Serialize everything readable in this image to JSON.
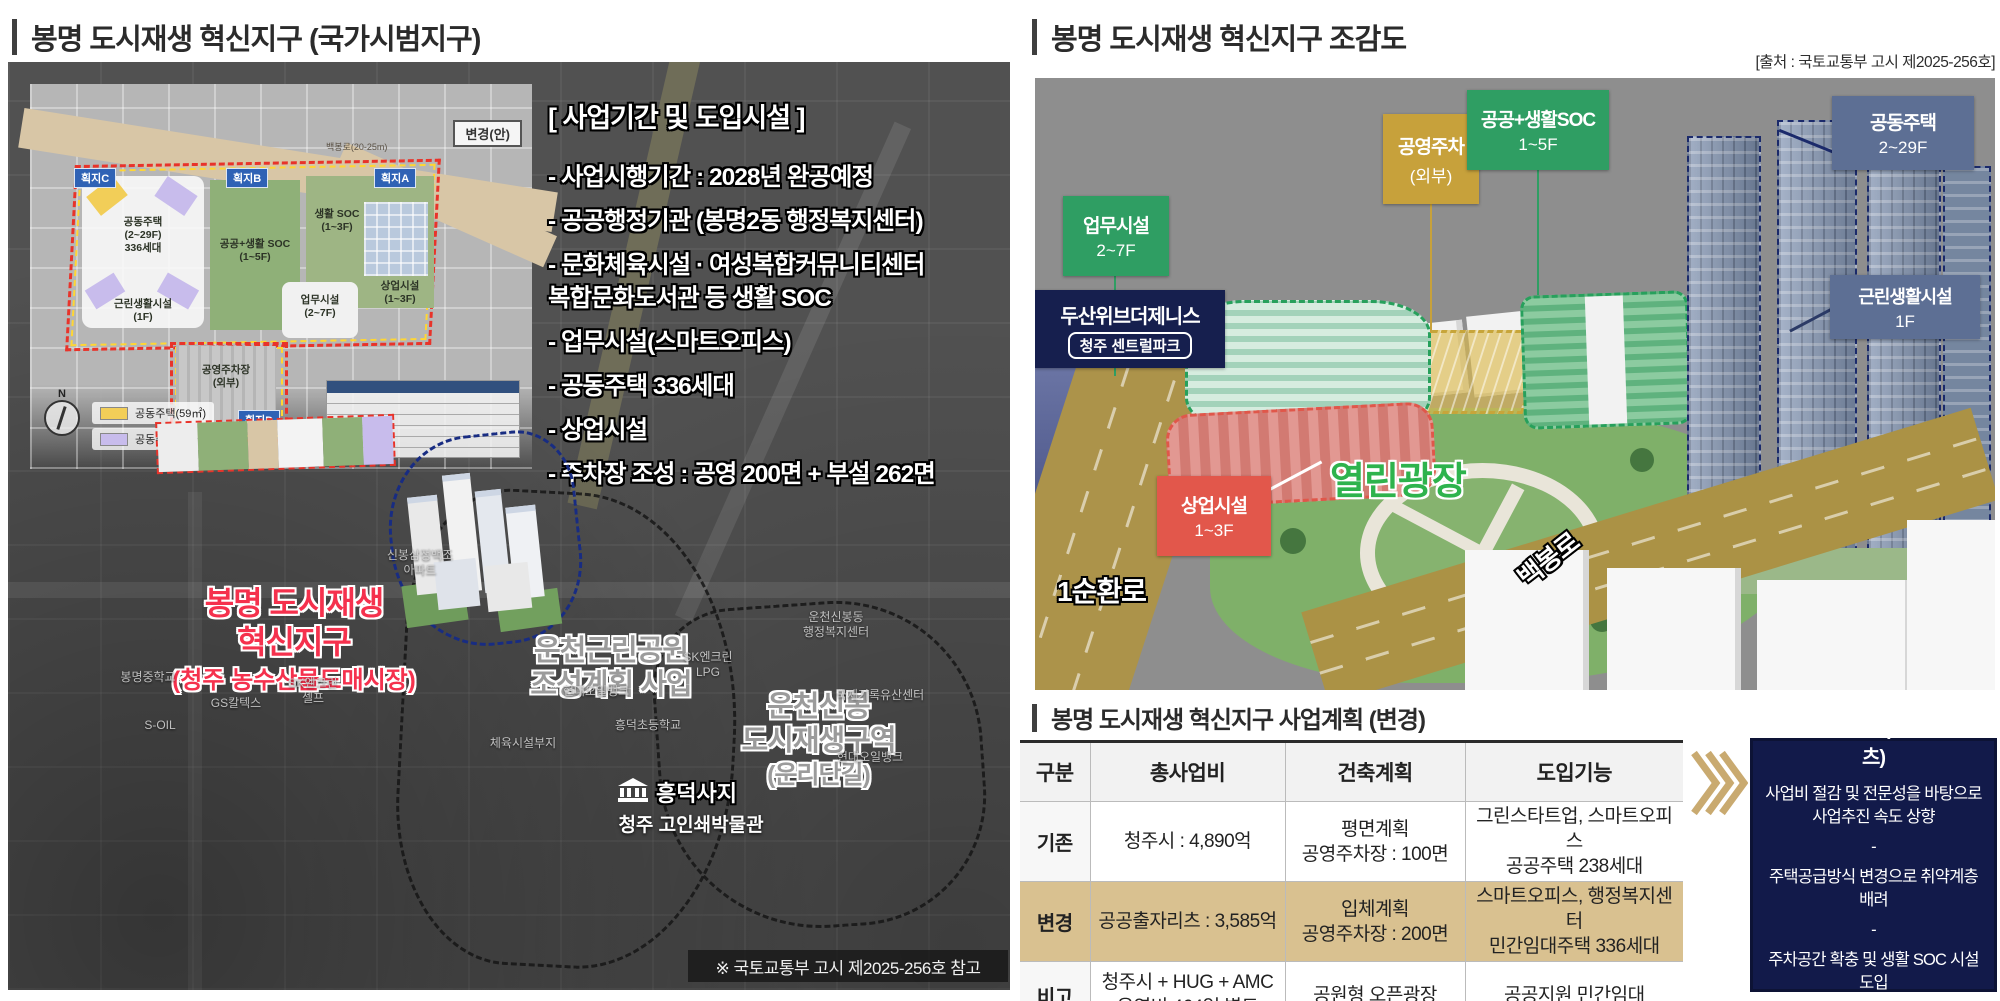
{
  "left": {
    "title": "봉명 도시재생 혁신지구 (국가시범지구)",
    "info": {
      "title": "[ 사업기간 및 도입시설 ]",
      "items": [
        "- 사업시행기간 : 2028년 완공예정",
        "- 공공행정기관 (봉명2동 행정복지센터)",
        "- 문화체육시설 · 여성복합커뮤니티센터\n   복합문화도서관 등 생활 SOC",
        "- 업무시설(스마트오피스)",
        "- 공동주택 336세대",
        "- 상업시설",
        "- 주차장 조성 : 공영 200면 + 부설 262면"
      ]
    },
    "inset": {
      "change_label": "변경(안)",
      "road": "백봉로(20-25m)",
      "zones": {
        "apartment": "공동주택\n(2~29F)\n336세대",
        "neighborhood": "근린생활시설\n(1F)",
        "soc": "공공+생활 SOC\n(1~5F)",
        "life_soc": "생활 SOC\n(1~3F)",
        "office": "업무시설\n(2~7F)",
        "commercial": "상업시설\n(1~3F)",
        "parking": "공영주차장\n(외부)"
      },
      "parcels": {
        "a": "획지A",
        "b": "획지B",
        "c": "획지C",
        "d": "획지D"
      },
      "legend": [
        "공동주택(59㎡)",
        "공동주택(84㎡)"
      ],
      "compass": "N"
    },
    "labels": {
      "district_l1": "봉명 도시재생",
      "district_l2": "혁신지구",
      "district_sub": "(청주 농수산물도매시장)",
      "park": "운천근린공원\n조성계획 사업",
      "unchon": "운천신봉\n도시재생구역",
      "unchon_sub": "(운리단길)",
      "heungdeok": "흥덕사지",
      "museum": "청주 고인쇄박물관",
      "small": [
        "봉명중학교",
        "SK엔크린\n셀프",
        "신봉삼정백조\n아파트",
        "S-OIL",
        "GS칼텍스",
        "현대오일뱅크",
        "체육시설부지",
        "SK엔크린\nLPG",
        "국제기록유산센터",
        "현대오일뱅크",
        "운천신봉동\n행정복지센터",
        "흥덕초등학교"
      ]
    },
    "footnote": "※ 국토교통부 고시 제2025-256호 참고"
  },
  "right": {
    "title": "봉명 도시재생 혁신지구 조감도",
    "source": "[출처 : 국토교통부 고시 제2025-256호]",
    "aerial": {
      "office_l1": "업무시설",
      "office_l2": "2~7F",
      "parking_l1": "공영주차",
      "parking_l2": "(외부)",
      "soc_l1": "공공+생활SOC",
      "soc_l2": "1~5F",
      "apt_l1": "공동주택",
      "apt_l2": "2~29F",
      "nbh_l1": "근린생활시설",
      "nbh_l2": "1F",
      "doosan_l1": "두산위브더제니스",
      "doosan_l2": "청주 센트럴파크",
      "com_l1": "상업시설",
      "com_l2": "1~3F",
      "plaza": "열린광장",
      "road1": "1순환로",
      "road2": "백봉로"
    },
    "plan": {
      "title": "봉명 도시재생 혁신지구 사업계획 (변경)",
      "table": {
        "headers": [
          "구분",
          "총사업비",
          "건축계획",
          "도입기능"
        ],
        "rows": [
          {
            "label": "기존",
            "cells": [
              "청주시 : 4,890억",
              "평면계획\n공영주차장 : 100면",
              "그린스타트업, 스마트오피스\n공공주택 238세대"
            ]
          },
          {
            "label": "변경",
            "cells": [
              "공공출자리츠 : 3,585억",
              "입체계획\n공영주차장 : 200면",
              "스마트오피스, 행정복지센터\n민간임대주택 336세대"
            ]
          },
          {
            "label": "비고",
            "cells": [
              "청주시 + HUG + AMC\n운영비 464억 별도",
              "공원형 오픈광장",
              "공공지원 민간임대"
            ]
          }
        ]
      },
      "benefit": {
        "title": "사업방법 변경 (공공출자리츠)",
        "items": [
          "사업비 절감 및 전문성을 바탕으로\n사업추진 속도 상향",
          "-",
          "주택공급방식 변경으로 취약계층 배려",
          "-",
          "주차공간 확충 및 생활 SOC 시설 도입\n주민편의 상향"
        ]
      }
    }
  },
  "colors": {
    "green_label": "#2f9e63",
    "gold_label": "#c7a13b",
    "slate_label": "#5d6f94",
    "navy_label": "#161f4e",
    "red_label": "#e2574b",
    "plaza_green": "#2eb34d",
    "district_red": "#f5314d",
    "highlight_row": "#d9c190"
  }
}
